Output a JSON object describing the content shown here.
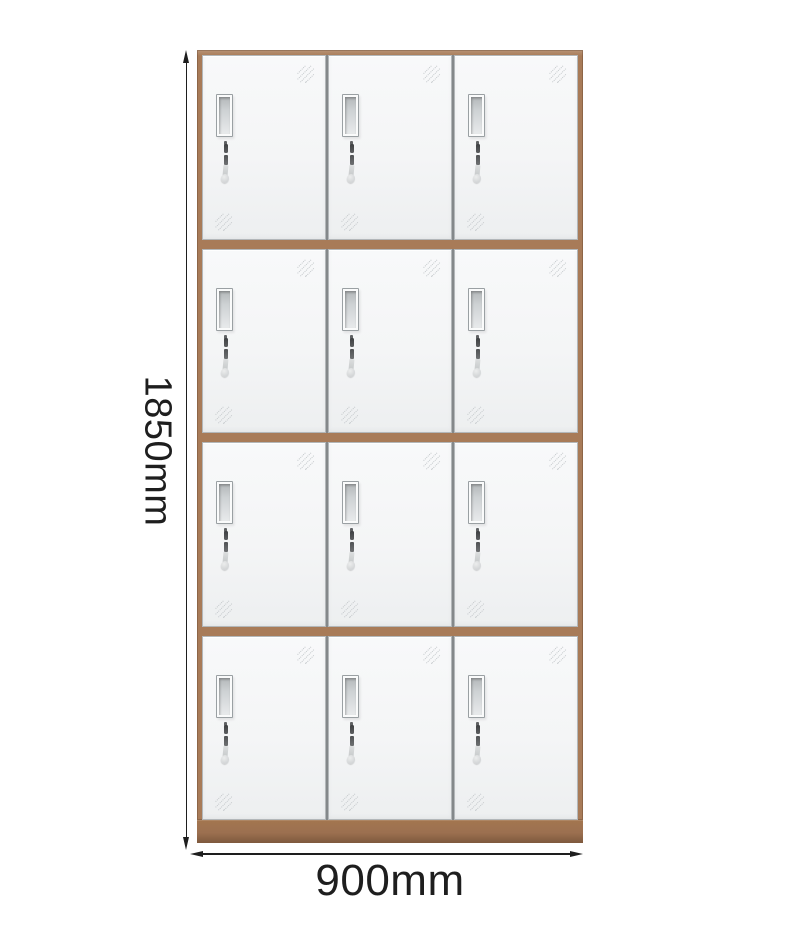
{
  "locker": {
    "rows": 4,
    "columns": 3,
    "door_count": 12
  },
  "dimensions": {
    "height_label": "1850mm",
    "width_label": "900mm"
  },
  "colors": {
    "background": "#ffffff",
    "frame_brown": "#a87b58",
    "base_brown": "#9c7050",
    "door_face": "#f5f6f7",
    "door_edge": "#b3b7b9",
    "divider_gray": "#84888a",
    "vent_shadow": "#9aa0a3",
    "glare_gray": "#c4c8cb",
    "dimension_ink": "#1e1e1e"
  }
}
